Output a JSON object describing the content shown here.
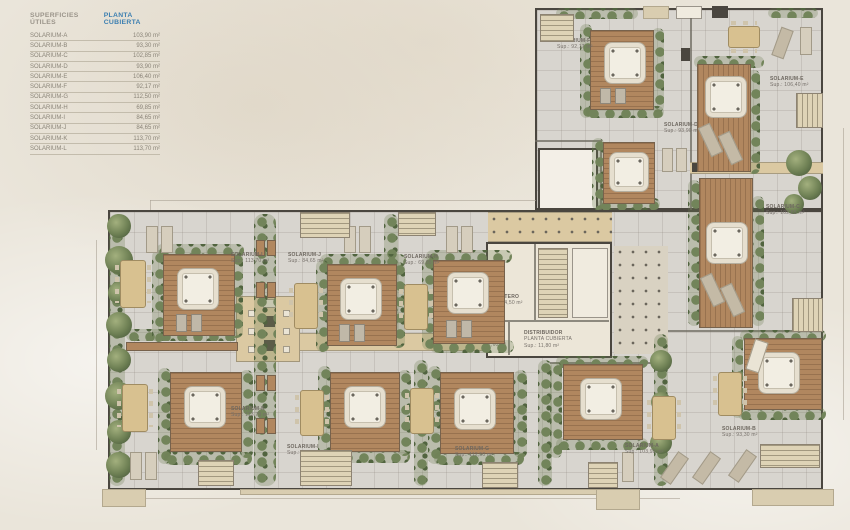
{
  "legend": {
    "title_left": "SUPERFICIES ÚTILES",
    "title_right": "PLANTA CUBIERTA",
    "accent_blue": "#3c7fb1",
    "rows": [
      {
        "name": "SOLARIUM-A",
        "value": "103,90 m²"
      },
      {
        "name": "SOLARIUM-B",
        "value": "93,30 m²"
      },
      {
        "name": "SOLARIUM-C",
        "value": "102,85 m²"
      },
      {
        "name": "SOLARIUM-D",
        "value": "93,90 m²"
      },
      {
        "name": "SOLARIUM-E",
        "value": "106,40 m²"
      },
      {
        "name": "SOLARIUM-F",
        "value": "92,17 m²"
      },
      {
        "name": "SOLARIUM-G",
        "value": "112,50 m²"
      },
      {
        "name": "SOLARIUM-H",
        "value": "69,85 m²"
      },
      {
        "name": "SOLARIUM-I",
        "value": "84,65 m²"
      },
      {
        "name": "SOLARIUM-J",
        "value": "84,65 m²"
      },
      {
        "name": "SOLARIUM-K",
        "value": "113,70 m²"
      },
      {
        "name": "SOLARIUM-L",
        "value": "113,70 m²"
      }
    ]
  },
  "plan": {
    "units": [
      {
        "name": "SOLARIUM-A",
        "sup": "Sup.: 103,90 m²"
      },
      {
        "name": "SOLARIUM-B",
        "sup": "Sup.: 93,30 m²"
      },
      {
        "name": "SOLARIUM-C",
        "sup": "Sup.: 102,85 m²"
      },
      {
        "name": "SOLARIUM-D",
        "sup": "Sup.: 93,90 m²"
      },
      {
        "name": "SOLARIUM-E",
        "sup": "Sup.: 106,40 m²"
      },
      {
        "name": "SOLARIUM-F",
        "sup": "Sup.: 92,17 m²"
      },
      {
        "name": "SOLARIUM-G",
        "sup": "Sup.: 112,50 m²"
      },
      {
        "name": "SOLARIUM-H",
        "sup": "Sup.: 69,85 m²"
      },
      {
        "name": "SOLARIUM-I",
        "sup": "Sup.: 84,65 m²"
      },
      {
        "name": "SOLARIUM-J",
        "sup": "Sup.: 84,65 m²"
      },
      {
        "name": "SOLARIUM-K",
        "sup": "Sup.: 113,70 m²"
      },
      {
        "name": "SOLARIUM-L",
        "sup": "Sup.: 113,70 m²"
      }
    ],
    "core": {
      "trastero": {
        "name": "TRASTERO",
        "sup": "Sup.: 4,50 m²"
      },
      "aseo": {
        "name": "ASEO",
        "sup": "2,60 m²"
      },
      "distribuidor": {
        "line1": "DISTRIBUIDOR",
        "line2": "PLANTA CUBIERTA",
        "sup": "Sup.: 11,80 m²"
      }
    },
    "colors": {
      "background": "#eae5da",
      "paving": "#d8d5cf",
      "deck_wood": "#b1875f",
      "hedge_green": "#72845a",
      "wall": "#4a463f",
      "stair": "#ded3b6"
    }
  }
}
